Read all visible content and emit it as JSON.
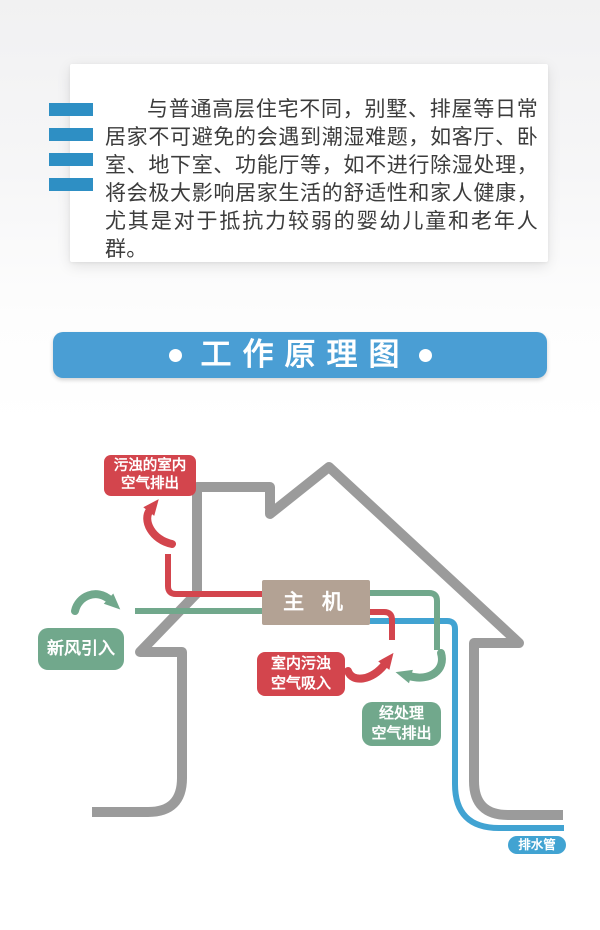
{
  "intro": {
    "paragraph": "与普通高层住宅不同，别墅、排屋等日常居家不可避免的会遇到潮湿难题，如客厅、卧室、地下室、功能厅等，如不进行除湿处理，将会极大影响居家生活的舒适性和家人健康，尤其是对于抵抗力较弱的婴幼儿童和老年人群。"
  },
  "banner": {
    "title": "工作原理图"
  },
  "diagram": {
    "main_unit_label": "主 机",
    "labels": {
      "dirty_air_out": {
        "line1": "污浊的室内",
        "line2": "空气排出"
      },
      "fresh_air_in": {
        "line1": "新风引入"
      },
      "dirty_air_in": {
        "line1": "室内污浊",
        "line2": "空气吸入"
      },
      "treated_air_out": {
        "line1": "经处理",
        "line2": "空气排出"
      },
      "drain_pipe": {
        "line1": "排水管"
      }
    }
  },
  "colors": {
    "red": "#d3454d",
    "green": "#71a88c",
    "blue": "#41a3d2",
    "house_gray": "#9b9b9b",
    "banner_blue": "#4a9ed4",
    "bar_blue": "#2e8fc4",
    "unit_tan": "#b3a294"
  }
}
